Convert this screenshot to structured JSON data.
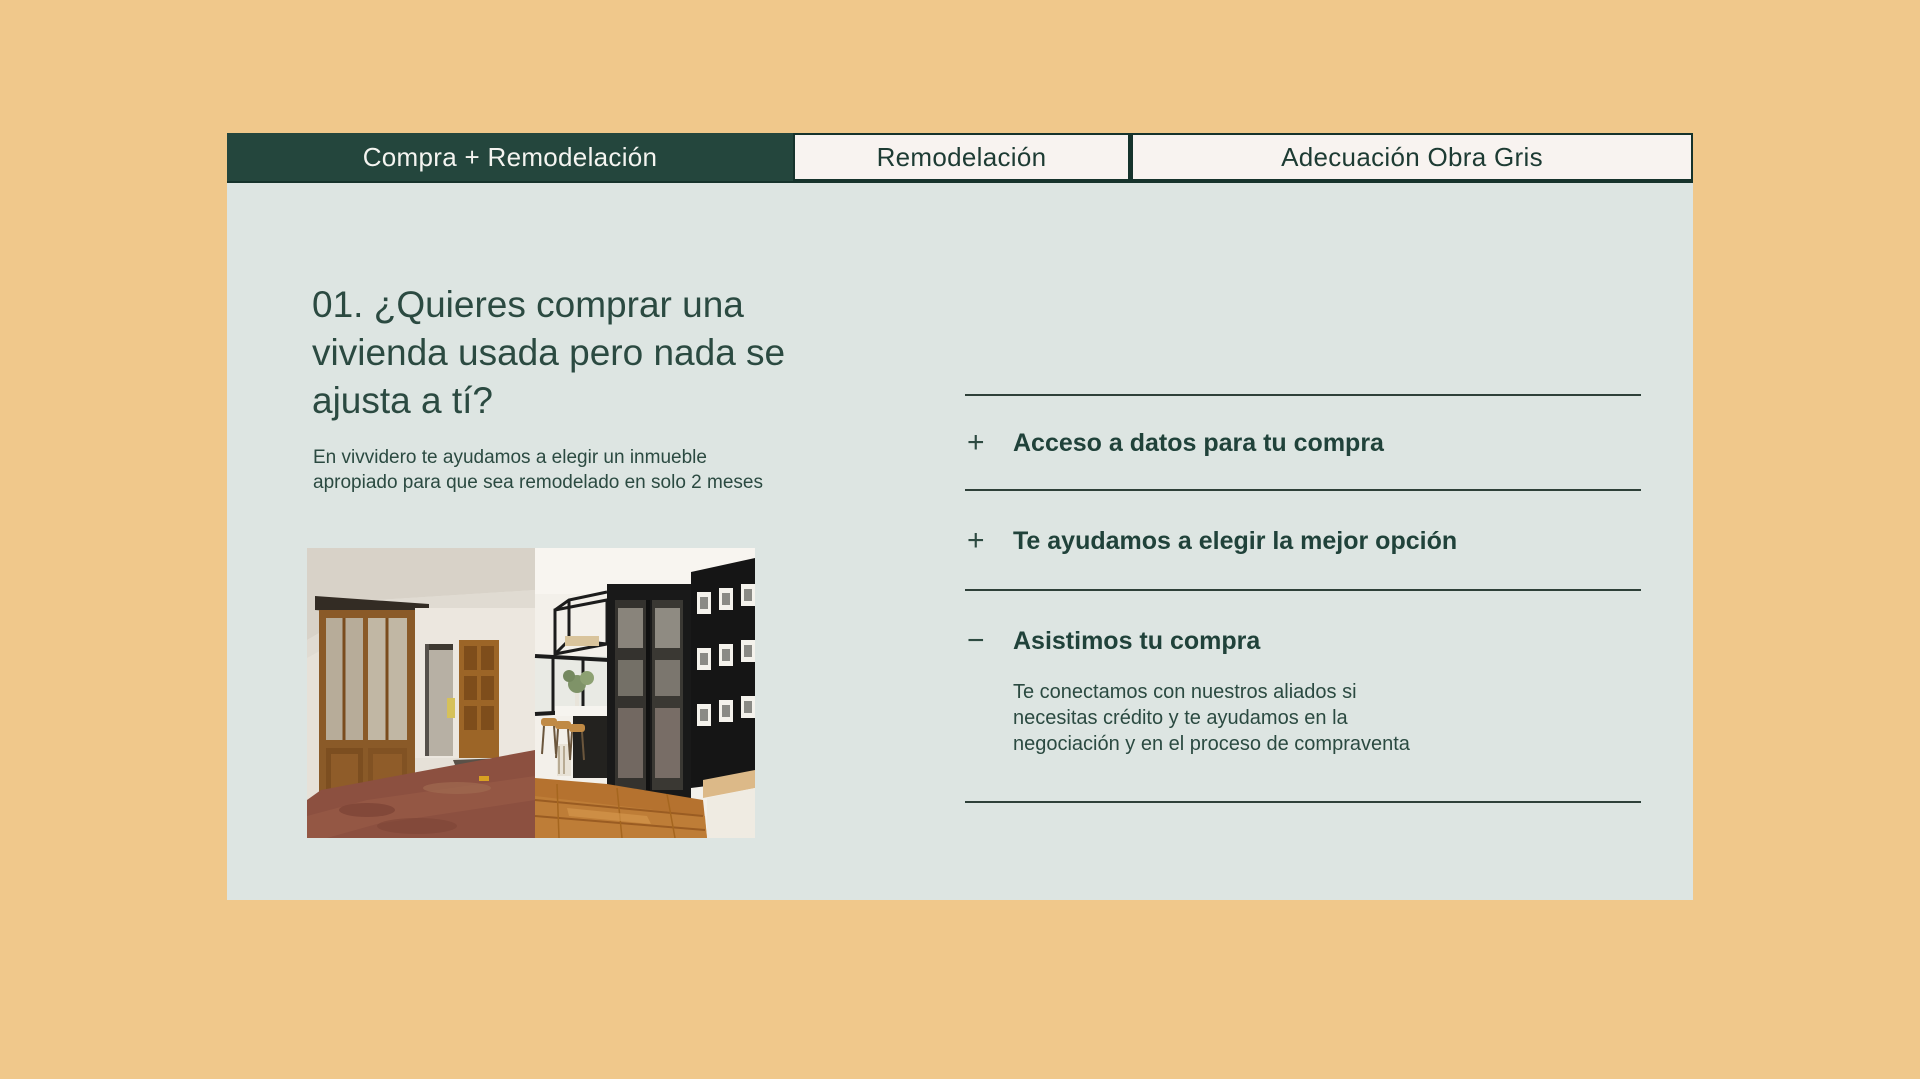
{
  "colors": {
    "page_background": "#f0c88b",
    "card_background": "#dde5e2",
    "active_tab_background": "#24463d",
    "inactive_tab_background": "#f8f3f0",
    "dark_green_text": "#2b4a41",
    "divider": "#2e4039"
  },
  "tabs": [
    {
      "label": "Compra + Remodelación",
      "active": true
    },
    {
      "label": "Remodelación",
      "active": false
    },
    {
      "label": "Adecuación Obra Gris",
      "active": false
    }
  ],
  "content": {
    "heading": "01. ¿Quieres comprar una vivienda usada pero nada se ajusta a tí?",
    "subheading": "En vivvidero te ayudamos a elegir un inmueble apropiado para que sea remodelado  en solo 2 meses",
    "photo_description": "before-and-after interior: old apartment with wooden cabinet and worn floor beside renovated modern space with black cabinet and gallery wall"
  },
  "accordion": [
    {
      "icon": "+",
      "title": "Acceso a datos para tu compra",
      "expanded": false
    },
    {
      "icon": "+",
      "title": "Te ayudamos a elegir la mejor opción",
      "expanded": false
    },
    {
      "icon": "−",
      "title": "Asistimos tu compra",
      "expanded": true,
      "body": "Te conectamos con nuestros aliados si necesitas crédito y te ayudamos en la negociación y en el proceso de compraventa"
    }
  ]
}
